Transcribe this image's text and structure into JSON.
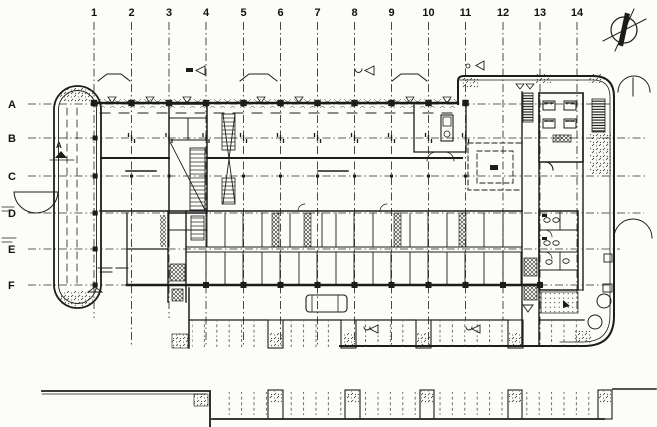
{
  "meta": {
    "title": "Architectural floor plan drawing",
    "type": "floor-plan"
  },
  "colors": {
    "paper": "#fcfcf9",
    "ink": "#1c1c1c"
  },
  "grid": {
    "columns": [
      {
        "label": "1",
        "x": 94,
        "y2": 318
      },
      {
        "label": "2",
        "x": 131.5,
        "y2": 347
      },
      {
        "label": "3",
        "x": 169,
        "y2": 318
      },
      {
        "label": "4",
        "x": 206,
        "y2": 347
      },
      {
        "label": "5",
        "x": 243.5,
        "y2": 347
      },
      {
        "label": "6",
        "x": 280.5,
        "y2": 347
      },
      {
        "label": "7",
        "x": 317.5,
        "y2": 347
      },
      {
        "label": "8",
        "x": 354.5,
        "y2": 347
      },
      {
        "label": "9",
        "x": 391.5,
        "y2": 347
      },
      {
        "label": "10",
        "x": 428.5,
        "y2": 347
      },
      {
        "label": "11",
        "x": 465.5,
        "y2": 320
      },
      {
        "label": "12",
        "x": 503,
        "y2": 320
      },
      {
        "label": "13",
        "x": 540,
        "y2": 345
      },
      {
        "label": "14",
        "x": 577,
        "y2": 312
      }
    ],
    "rows": [
      {
        "label": "A",
        "y": 104,
        "x2": 612
      },
      {
        "label": "B",
        "y": 138,
        "x2": 648
      },
      {
        "label": "C",
        "y": 176,
        "x2": 648
      },
      {
        "label": "D",
        "y": 213,
        "x2": 644
      },
      {
        "label": "E",
        "y": 249,
        "x2": 620
      },
      {
        "label": "F",
        "y": 285,
        "x2": 612
      }
    ],
    "top_columns_cols": [
      0,
      1,
      2,
      3,
      4,
      5,
      6,
      7,
      8,
      9,
      10
    ],
    "bottom_columns_cols": [
      3,
      4,
      5,
      6,
      7,
      8,
      9,
      10,
      11,
      12
    ],
    "bay_marker_cols": [
      1,
      2,
      3,
      4,
      5,
      6,
      7,
      8,
      9,
      10
    ]
  },
  "annotations": {
    "section_marker": "A"
  }
}
